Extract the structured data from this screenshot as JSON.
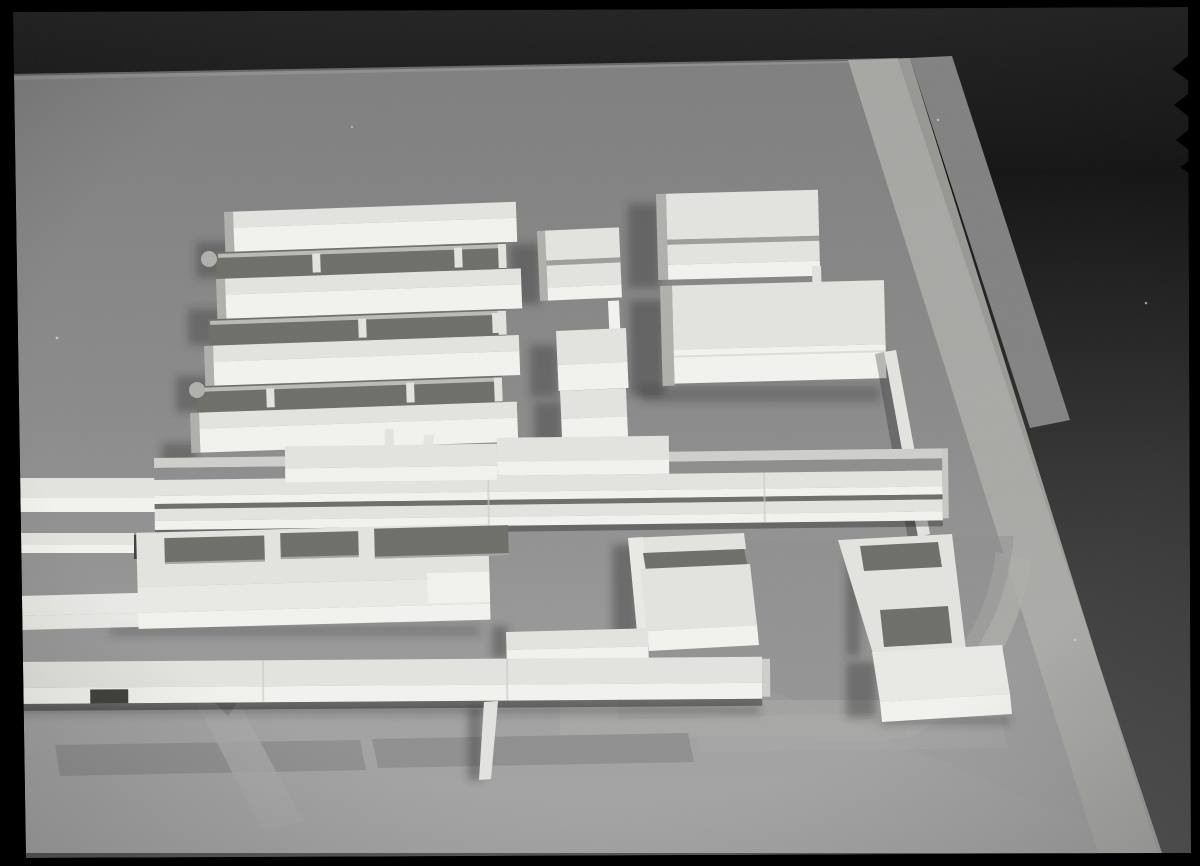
{
  "image": {
    "alt_text": "Black-and-white film photograph of a wooden architectural scale model seen from above at an oblique angle: rows of slab buildings, courtyard blocks and long bars arranged on a gray baseboard standing on a dark tabletop, framed by a black film-negative border with edge notches",
    "style": "black-and-white film photograph",
    "subject": "architectural site model of a building complex",
    "scene_elements": [
      "film-negative black border with edge notches and faint edge markings",
      "dark tabletop background",
      "gray model baseboard",
      "perimeter street strip along the upper-right edge of the board",
      "four parallel slab buildings with recessed courts, low walls, pillars and two round bumps",
      "stepped column of three small blocks with a connecting wall",
      "two large rectangular blocks at upper right, one with a roof groove",
      "thin enclosure wall behind the lower large block",
      "east-west spine of low bars with two raised slabs and a small pin",
      "flat courtyard building with three rectangular openings and front terrace",
      "c-shaped court building",
      "l-shaped slab with two square courts",
      "corner block at lower right",
      "long bottom bar with a notch and a freestanding post",
      "curved road and path markings on the lower part of the board",
      "dust specks and film grain"
    ]
  },
  "palette": {
    "film_black": "#000000",
    "table_grad_0": "#232323",
    "table_grad_1": "#131313",
    "table_grad_2": "#343434",
    "table_grad_3": "#575757",
    "base_top": "#7f7f7f",
    "base_mid": "#8b8b8b",
    "base_bottom": "#a6a6a6",
    "base_edge_light": "#9a9a9a",
    "road_light": "#aeaeaa",
    "road_medium": "#8e8e8e",
    "path_light": "#a9a9a9",
    "curb": "#cfcfcb",
    "block_top": "#e4e4e0",
    "block_front": "#f3f3ef",
    "block_side": "#b0b0ac",
    "terrace": "#eaeae6",
    "court_shadow": "#6f6f69",
    "groove": "#9e9e9a",
    "seam": "#c9c9c5",
    "notch_dark": "#3f3f3b",
    "cast_shadow": "#2e2e2c",
    "edge_mark": "#c8c8c8",
    "speck": "#ffffff"
  }
}
